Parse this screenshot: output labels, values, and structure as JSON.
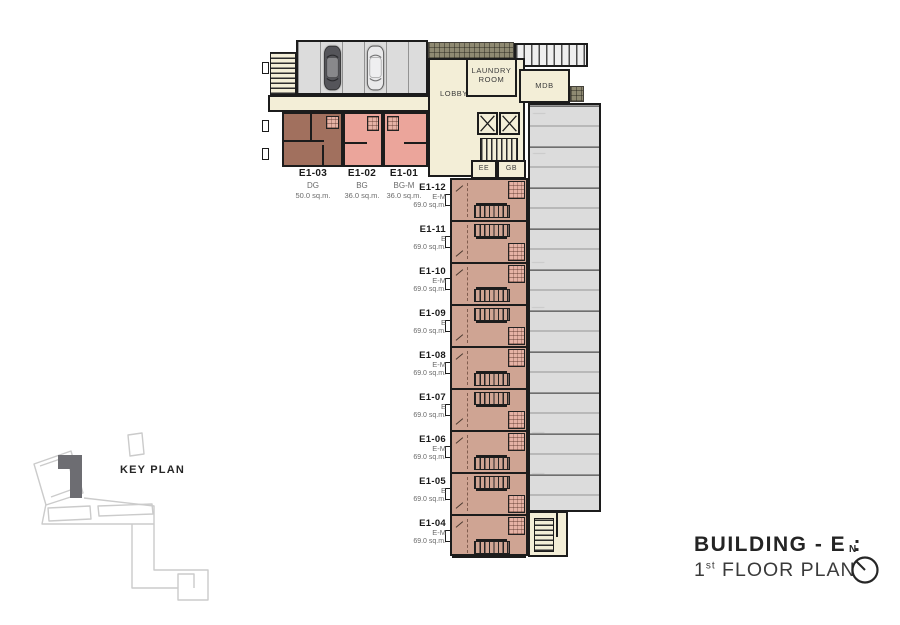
{
  "palette": {
    "wall": "#1c1c1c",
    "cream_room": "#f3eed7",
    "pink_unit": "#eba59b",
    "brown_unit": "#a1705e",
    "salmon_unit": "#cfa493",
    "parking_gray": "#dcdcdc",
    "walkway_hatch": "#8f8a72",
    "keyplan_highlight": "#6d6d72",
    "keyplan_outline": "#cbcbcb"
  },
  "header": {
    "building_title": "BUILDING - E :",
    "floor_number": "1",
    "floor_ordinal": "st",
    "floor_label": " FLOOR PLAN",
    "north_label": "N"
  },
  "key_plan": {
    "label": "KEY PLAN"
  },
  "rooms": {
    "lobby": "LOBBY",
    "laundry_line1": "LAUNDRY",
    "laundry_line2": "ROOM",
    "mdb": "MDB",
    "ee": "EE",
    "gb": "GB"
  },
  "top_units": [
    {
      "id": "E1-03",
      "type": "DG",
      "area": "50.0 sq.m."
    },
    {
      "id": "E1-02",
      "type": "BG",
      "area": "36.0 sq.m."
    },
    {
      "id": "E1-01",
      "type": "BG-M",
      "area": "36.0 sq.m."
    }
  ],
  "strip_units": [
    {
      "id": "E1-12",
      "type": "E-M",
      "area": "69.0 sq.m."
    },
    {
      "id": "E1-11",
      "type": "E",
      "area": "69.0 sq.m."
    },
    {
      "id": "E1-10",
      "type": "E-M",
      "area": "69.0 sq.m."
    },
    {
      "id": "E1-09",
      "type": "E",
      "area": "69.0 sq.m."
    },
    {
      "id": "E1-08",
      "type": "E-M",
      "area": "69.0 sq.m."
    },
    {
      "id": "E1-07",
      "type": "E",
      "area": "69.0 sq.m."
    },
    {
      "id": "E1-06",
      "type": "E-M",
      "area": "69.0 sq.m."
    },
    {
      "id": "E1-05",
      "type": "E",
      "area": "69.0 sq.m."
    },
    {
      "id": "E1-04",
      "type": "E-M",
      "area": "69.0 sq.m."
    }
  ]
}
